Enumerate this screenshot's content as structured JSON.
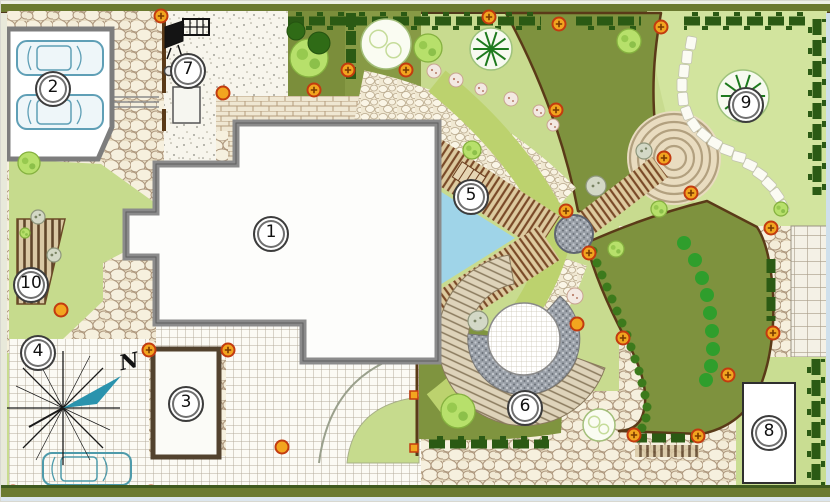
{
  "plan": {
    "markers": [
      {
        "label": "1"
      },
      {
        "label": "2"
      },
      {
        "label": "3"
      },
      {
        "label": "4"
      },
      {
        "label": "5"
      },
      {
        "label": "6"
      },
      {
        "label": "7"
      },
      {
        "label": "8"
      },
      {
        "label": "9"
      },
      {
        "label": "10"
      }
    ],
    "compass": {
      "north_label": "N"
    },
    "colors": {
      "lawn_light": "#c8db8f",
      "lawn_pale": "#d2e49e",
      "lawn_dark": "#7e923e",
      "band_green": "#bcd26e",
      "water": "#9fd4e8",
      "lamp": "#f2a51f",
      "lamp_ring": "#c23b0f",
      "hedge": "#2b5a14",
      "deck": "#7a4a28",
      "wall_gray": "#8b8b8b",
      "fence_brown": "#5a3a18",
      "cobble_bg": "#e7dcc2",
      "car_outline": "#5f9fb6"
    }
  }
}
